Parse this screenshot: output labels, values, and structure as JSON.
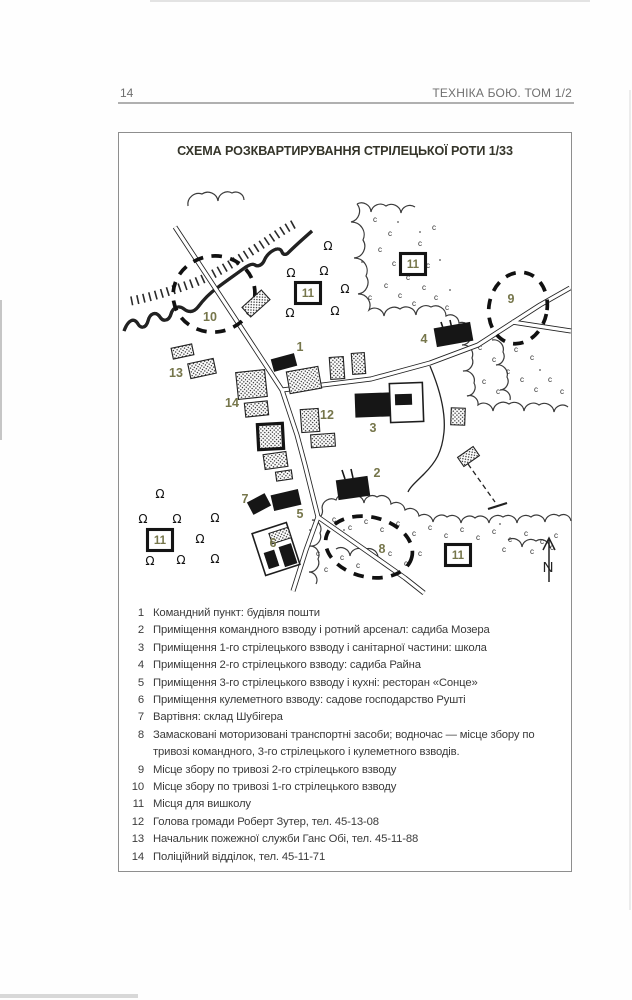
{
  "page": {
    "number": "14",
    "book_title": "ТЕХНІКА БОЮ. ТОМ 1/2"
  },
  "figure": {
    "title": "СХЕМА РОЗКВАРТИРУВАННЯ СТРІЛЕЦЬКОЇ РОТИ 1/33"
  },
  "map": {
    "label_color": "#76764b",
    "compass_label": "N",
    "training_symbol": "Ω",
    "plain_labels": [
      {
        "text": "1",
        "x": 300,
        "y": 351
      },
      {
        "text": "2",
        "x": 377,
        "y": 477
      },
      {
        "text": "3",
        "x": 373,
        "y": 432
      },
      {
        "text": "4",
        "x": 424,
        "y": 343
      },
      {
        "text": "5",
        "x": 300,
        "y": 518
      },
      {
        "text": "6",
        "x": 273,
        "y": 547
      },
      {
        "text": "7",
        "x": 245,
        "y": 503
      },
      {
        "text": "8",
        "x": 382,
        "y": 553
      },
      {
        "text": "9",
        "x": 511,
        "y": 303
      },
      {
        "text": "10",
        "x": 210,
        "y": 321
      },
      {
        "text": "12",
        "x": 327,
        "y": 419
      },
      {
        "text": "13",
        "x": 176,
        "y": 377
      },
      {
        "text": "14",
        "x": 232,
        "y": 407
      }
    ],
    "boxed_labels": [
      {
        "text": "11",
        "x": 308,
        "y": 293
      },
      {
        "text": "11",
        "x": 413,
        "y": 264
      },
      {
        "text": "11",
        "x": 160,
        "y": 540
      },
      {
        "text": "11",
        "x": 458,
        "y": 555
      }
    ],
    "training_spots": [
      [
        328,
        246
      ],
      [
        291,
        273
      ],
      [
        324,
        271
      ],
      [
        345,
        289
      ],
      [
        290,
        313
      ],
      [
        335,
        311
      ],
      [
        160,
        494
      ],
      [
        143,
        519
      ],
      [
        177,
        519
      ],
      [
        215,
        518
      ],
      [
        200,
        539
      ],
      [
        150,
        561
      ],
      [
        181,
        560
      ],
      [
        215,
        559
      ]
    ]
  },
  "legend": {
    "items": [
      {
        "num": "1",
        "text": "Командний пункт: будівля пошти"
      },
      {
        "num": "2",
        "text": "Приміщення командного взводу і ротний арсенал: садиба Мозера"
      },
      {
        "num": "3",
        "text": "Приміщення 1-го стрілецького взводу і санітарної частини: школа"
      },
      {
        "num": "4",
        "text": "Приміщення 2-го стрілецького взводу: садиба Райна"
      },
      {
        "num": "5",
        "text": "Приміщення 3-го стрілецького взводу і кухні: ресторан «Сонце»"
      },
      {
        "num": "6",
        "text": "Приміщення кулеметного взводу: садове господарство Рушті"
      },
      {
        "num": "7",
        "text": "Вартівня: склад Шубігера"
      },
      {
        "num": "8",
        "text": "Замасковані моторизовані транспортні засоби; водночас — місце збору по тривозі командного, 3-го стрілецького і кулеметного взводів."
      },
      {
        "num": "9",
        "text": "Місце збору по тривозі 2-го стрілецького взводу"
      },
      {
        "num": "10",
        "text": "Місце збору по тривозі 1-го стрілецького взводу"
      },
      {
        "num": "11",
        "text": "Місця для вишколу"
      },
      {
        "num": "12",
        "text": "Голова громади Роберт Зутер, тел. 45-13-08"
      },
      {
        "num": "13",
        "text": "Начальник пожежної служби Ганс Обі, тел. 45-11-88"
      },
      {
        "num": "14",
        "text": "Поліційний відділок, тел. 45-11-71"
      }
    ]
  }
}
